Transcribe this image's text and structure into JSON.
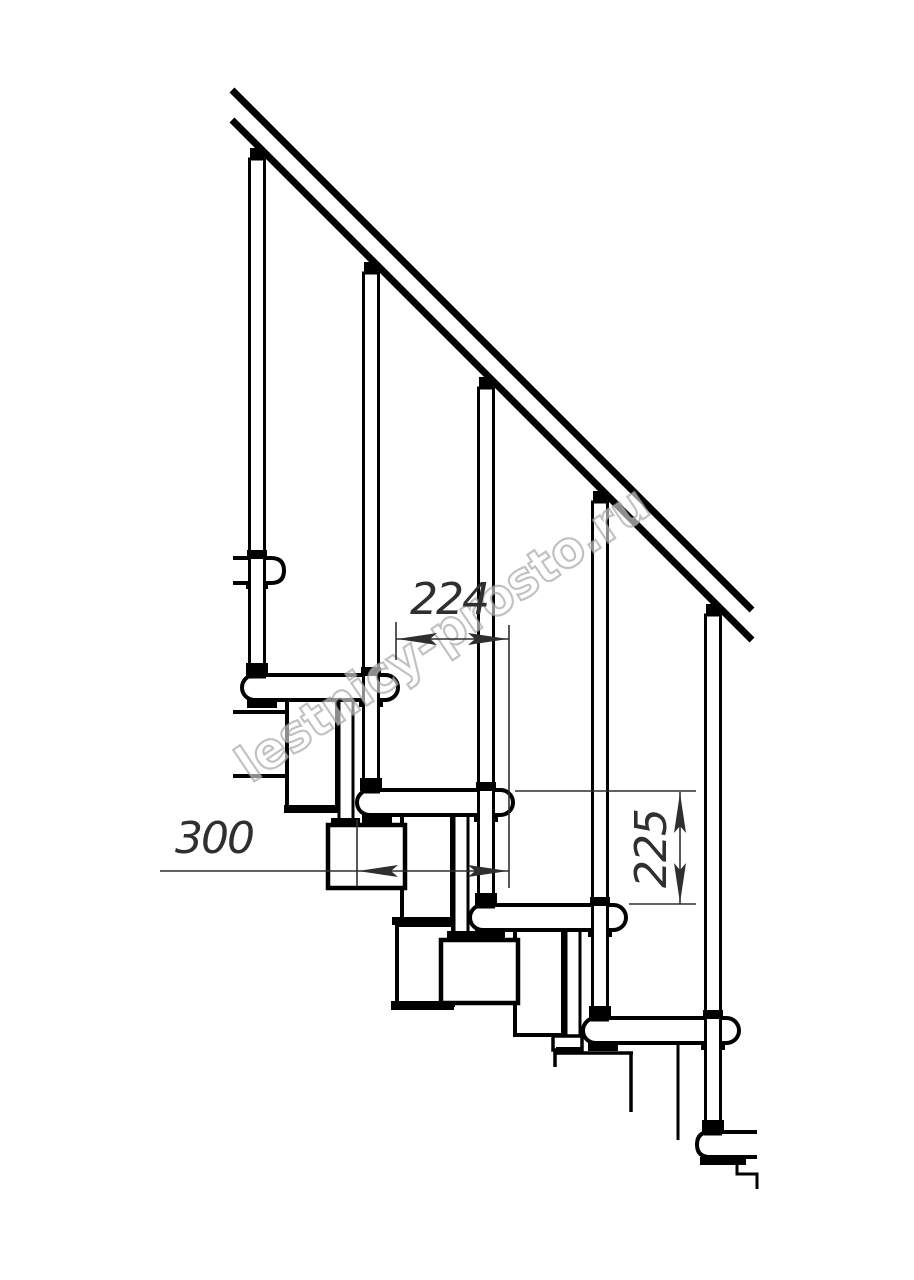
{
  "drawing": {
    "kind": "staircase-side-view-technical-drawing",
    "watermark": {
      "text": "lestnicy-prosto.ru"
    },
    "dimensions": {
      "step_run": {
        "value": "224"
      },
      "tread_depth": {
        "value": "300"
      },
      "riser_height": {
        "value": "225"
      }
    },
    "colors": {
      "background": "#ffffff",
      "line": "#000000",
      "dim": "#2f2f2f",
      "watermark_stroke": "#a0a0a0",
      "watermark_fill": "#ffffff"
    }
  }
}
